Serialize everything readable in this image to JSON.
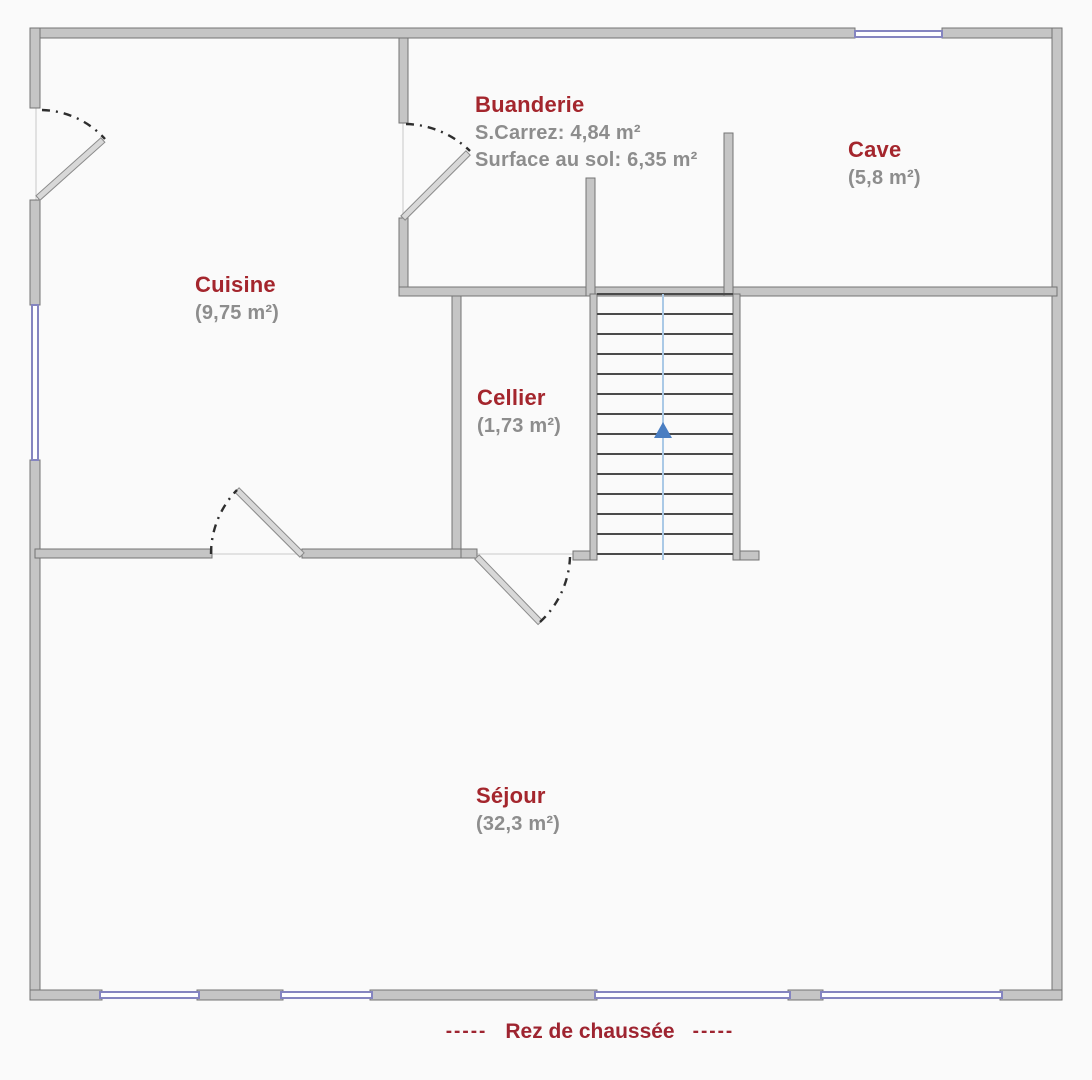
{
  "title": "Rez de chaussée",
  "caption": {
    "prefix": "-----",
    "text": "Rez de chaussée",
    "suffix": "-----"
  },
  "rooms": [
    {
      "id": "buanderie",
      "name": "Buanderie",
      "detail1": "S.Carrez: 4,84 m²",
      "detail2": "Surface au sol: 6,35 m²"
    },
    {
      "id": "cave",
      "name": "Cave",
      "area": "(5,8 m²)"
    },
    {
      "id": "cuisine",
      "name": "Cuisine",
      "area": "(9,75 m²)"
    },
    {
      "id": "cellier",
      "name": "Cellier",
      "area": "(1,73 m²)"
    },
    {
      "id": "sejour",
      "name": "Séjour",
      "area": "(32,3 m²)"
    }
  ],
  "stairs": {
    "steps": 13,
    "direction_arrow": "up"
  },
  "colors": {
    "room_label": "#a4262d",
    "area_text": "#8d8d8d",
    "wall_fill": "#c5c5c5",
    "wall_edge": "#747474",
    "window": "#8585c0",
    "stair_tread": "#4a4a4a",
    "stair_axis": "#aac9e6",
    "stair_arrow": "#4a7ec2"
  }
}
